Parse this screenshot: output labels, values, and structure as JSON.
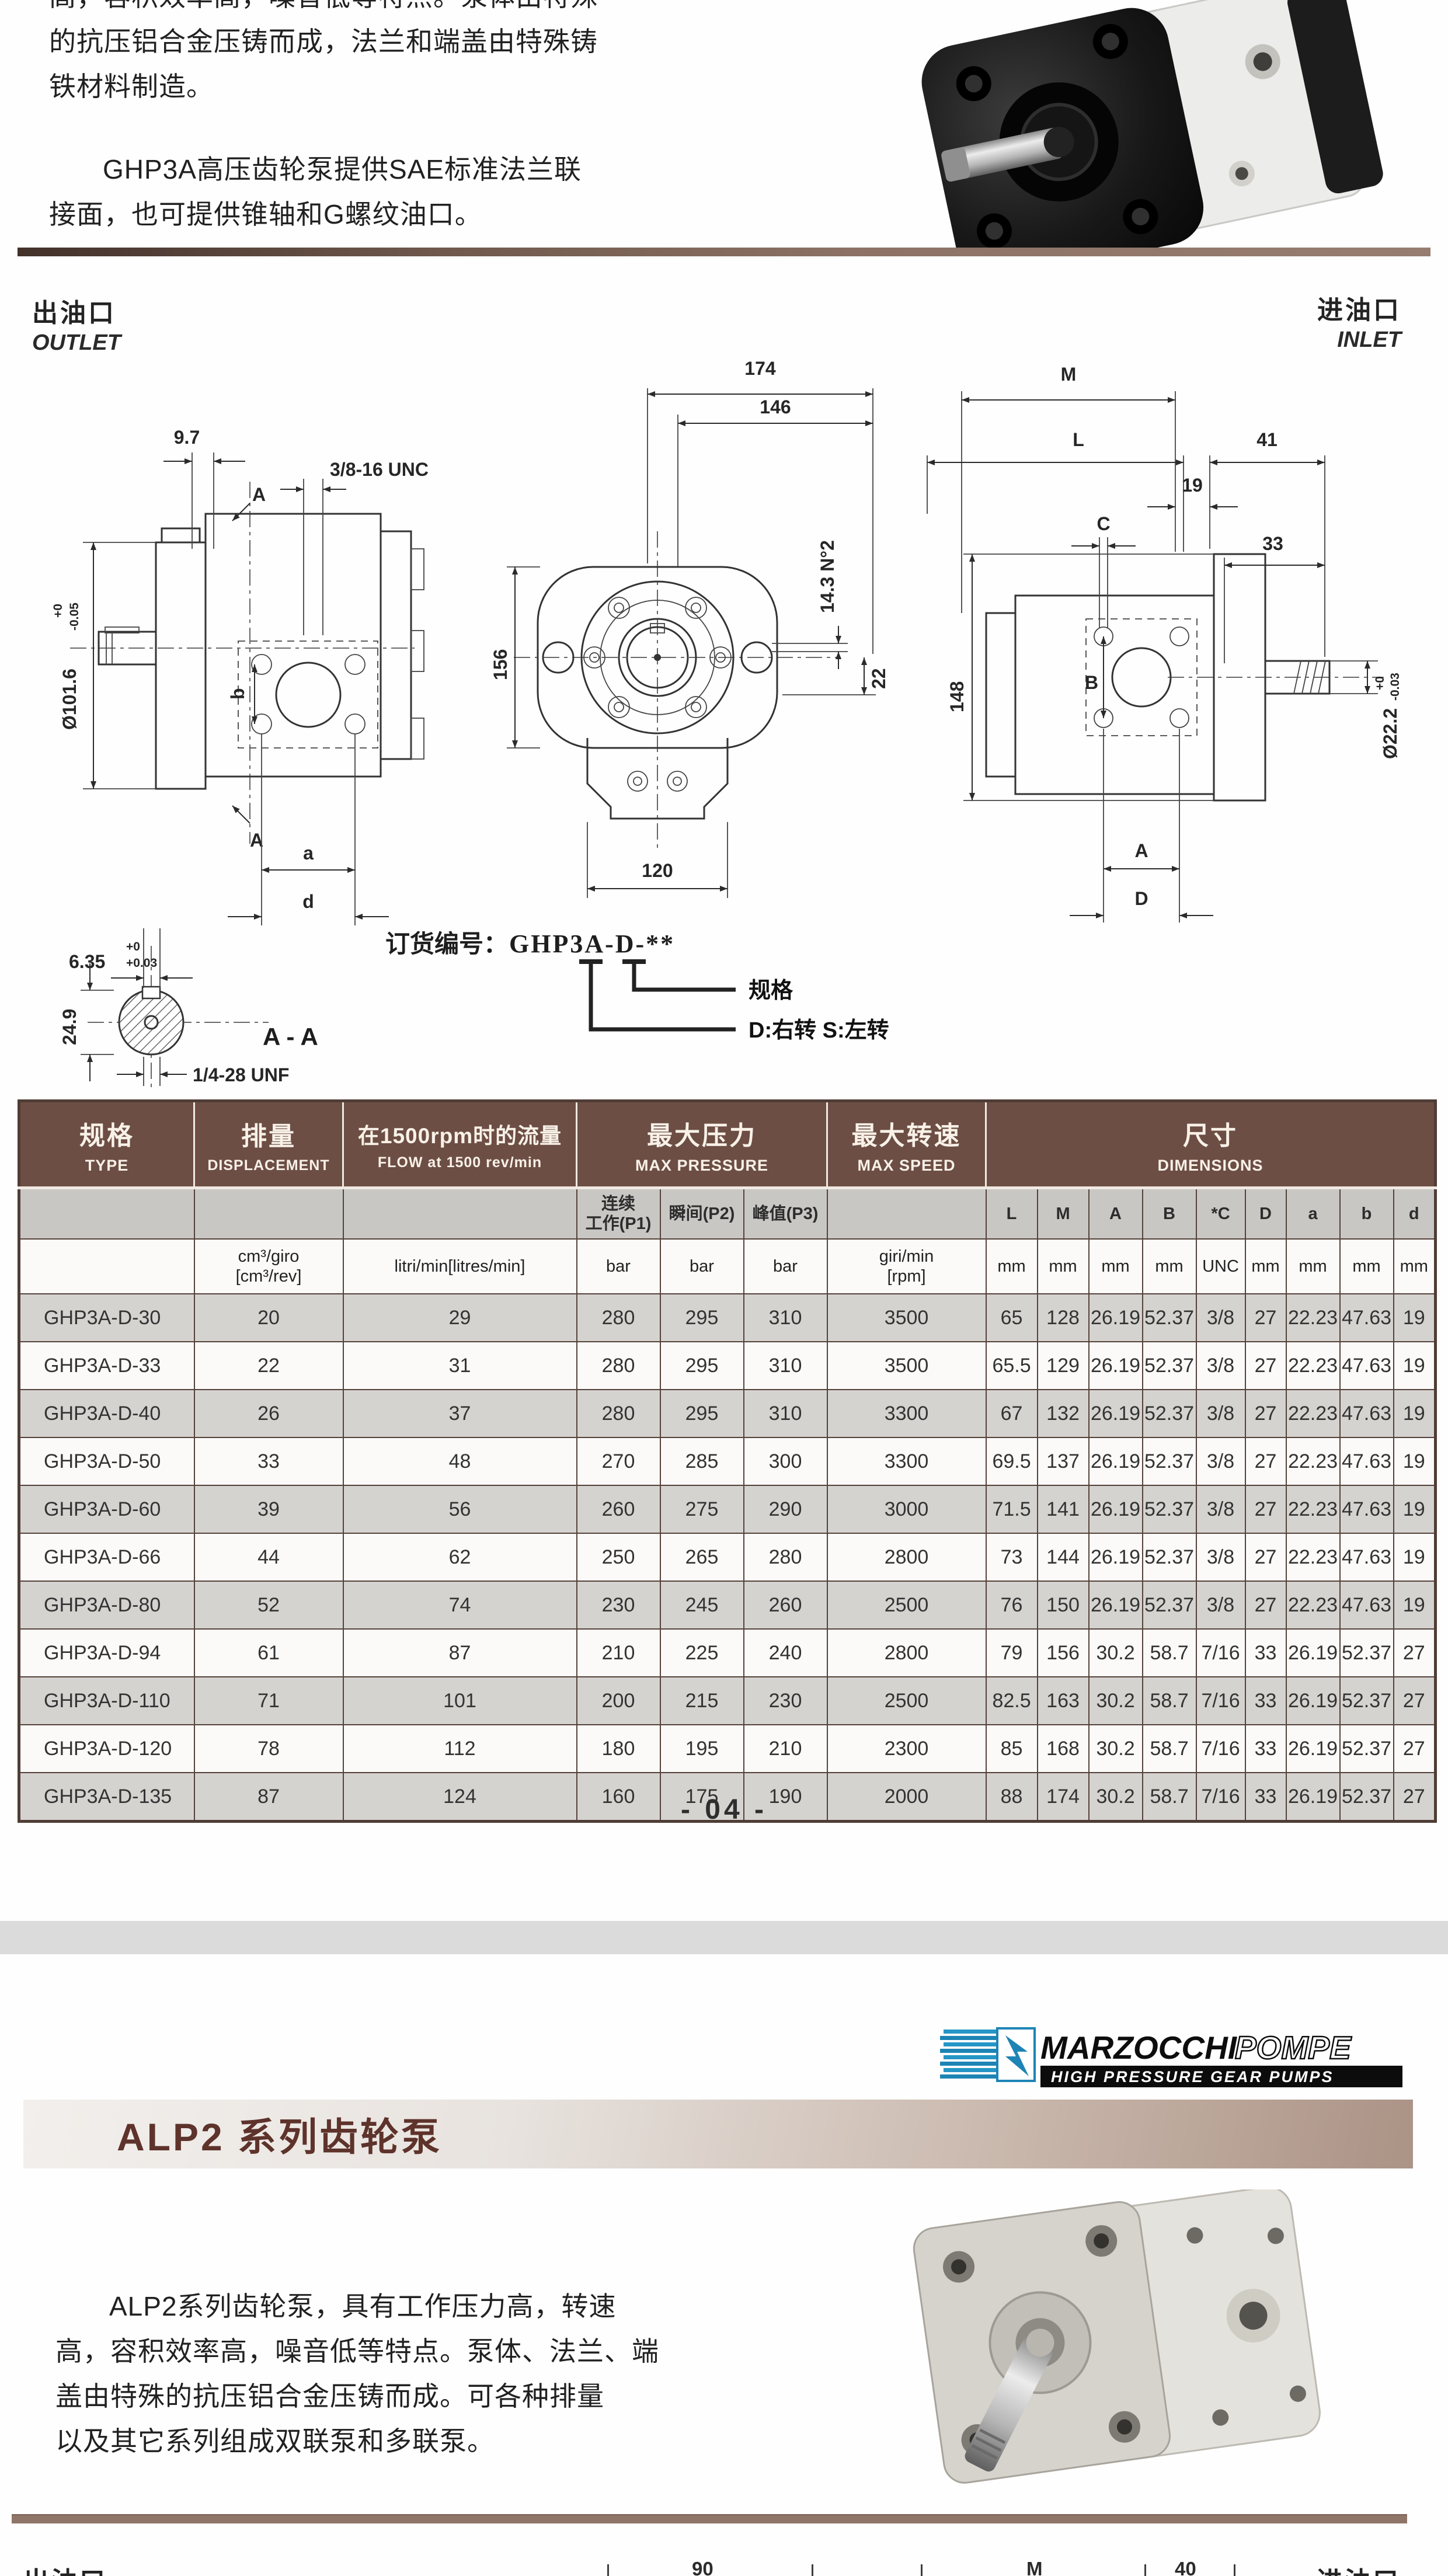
{
  "doc": {
    "page_number": "- 04 -"
  },
  "ghp3a": {
    "para1_clipped": "高，容积效率高，噪音低等特点。泵体由特殊",
    "para1_line2": "的抗压铝合金压铸而成，法兰和端盖由特殊铸",
    "para1_line3": "铁材料制造。",
    "para2_line1": "GHP3A高压齿轮泵提供SAE标准法兰联",
    "para2_line2": "接面，也可提供锥轴和G螺纹油口。",
    "outlet_cn": "出油口",
    "outlet_en": "OUTLET",
    "inlet_cn": "进油口",
    "inlet_en": "INLET",
    "order_code_label": "订货编号：",
    "order_code": "GHP3A-D-**",
    "callout_spec": "规格",
    "callout_rotation": "D:右转  S:左转"
  },
  "drawing_left": {
    "dim_9_7": "9.7",
    "thread": "3/8-16 UNC",
    "section_mark_top": "A",
    "section_mark_bottom": "A",
    "dia": "Ø101.6",
    "dia_tol_top": "+0",
    "dia_tol_bot": "-0.05",
    "dim_b": "b",
    "dim_a": "a",
    "dim_d": "d"
  },
  "shaft_section": {
    "dim_6_35": "6.35",
    "tol_top": "+0",
    "tol_bot": "+0.03",
    "dim_24_9": "24.9",
    "thread": "1/4-28 UNF",
    "title": "A - A"
  },
  "drawing_center": {
    "dim_174": "174",
    "dim_146": "146",
    "dim_156": "156",
    "dim_14_3": "14.3 N°2",
    "dim_22": "22",
    "dim_120": "120"
  },
  "drawing_right": {
    "dim_M": "M",
    "dim_L": "L",
    "dim_41": "41",
    "dim_19": "19",
    "dim_C": "C",
    "dim_33": "33",
    "dim_148": "148",
    "dim_B": "B",
    "dim_A": "A",
    "dim_D": "D",
    "dia": "Ø22.2",
    "dia_tol_top": "+0",
    "dia_tol_bot": "-0.03"
  },
  "table": {
    "header": {
      "type_cn": "规格",
      "type_en": "TYPE",
      "disp_cn": "排量",
      "disp_en": "DISPLACEMENT",
      "flow_cn": "在1500rpm时的流量",
      "flow_en": "FLOW at 1500 rev/min",
      "pressure_cn": "最大压力",
      "pressure_en": "MAX PRESSURE",
      "speed_cn": "最大转速",
      "speed_en": "MAX SPEED",
      "dims_cn": "尺寸",
      "dims_en": "DIMENSIONS"
    },
    "subheader": [
      "",
      "",
      "",
      "连续\n工作(P1)",
      "瞬间(P2)",
      "峰值(P3)",
      "",
      "L",
      "M",
      "A",
      "B",
      "*C",
      "D",
      "a",
      "b",
      "d"
    ],
    "units": [
      "",
      "cm³/giro\n[cm³/rev]",
      "litri/min[litres/min]",
      "bar",
      "bar",
      "bar",
      "giri/min\n[rpm]",
      "mm",
      "mm",
      "mm",
      "mm",
      "UNC",
      "mm",
      "mm",
      "mm",
      "mm"
    ],
    "rows": [
      [
        "GHP3A-D-30",
        "20",
        "29",
        "280",
        "295",
        "310",
        "3500",
        "65",
        "128",
        "26.19",
        "52.37",
        "3/8",
        "27",
        "22.23",
        "47.63",
        "19"
      ],
      [
        "GHP3A-D-33",
        "22",
        "31",
        "280",
        "295",
        "310",
        "3500",
        "65.5",
        "129",
        "26.19",
        "52.37",
        "3/8",
        "27",
        "22.23",
        "47.63",
        "19"
      ],
      [
        "GHP3A-D-40",
        "26",
        "37",
        "280",
        "295",
        "310",
        "3300",
        "67",
        "132",
        "26.19",
        "52.37",
        "3/8",
        "27",
        "22.23",
        "47.63",
        "19"
      ],
      [
        "GHP3A-D-50",
        "33",
        "48",
        "270",
        "285",
        "300",
        "3300",
        "69.5",
        "137",
        "26.19",
        "52.37",
        "3/8",
        "27",
        "22.23",
        "47.63",
        "19"
      ],
      [
        "GHP3A-D-60",
        "39",
        "56",
        "260",
        "275",
        "290",
        "3000",
        "71.5",
        "141",
        "26.19",
        "52.37",
        "3/8",
        "27",
        "22.23",
        "47.63",
        "19"
      ],
      [
        "GHP3A-D-66",
        "44",
        "62",
        "250",
        "265",
        "280",
        "2800",
        "73",
        "144",
        "26.19",
        "52.37",
        "3/8",
        "27",
        "22.23",
        "47.63",
        "19"
      ],
      [
        "GHP3A-D-80",
        "52",
        "74",
        "230",
        "245",
        "260",
        "2500",
        "76",
        "150",
        "26.19",
        "52.37",
        "3/8",
        "27",
        "22.23",
        "47.63",
        "19"
      ],
      [
        "GHP3A-D-94",
        "61",
        "87",
        "210",
        "225",
        "240",
        "2800",
        "79",
        "156",
        "30.2",
        "58.7",
        "7/16",
        "33",
        "26.19",
        "52.37",
        "27"
      ],
      [
        "GHP3A-D-110",
        "71",
        "101",
        "200",
        "215",
        "230",
        "2500",
        "82.5",
        "163",
        "30.2",
        "58.7",
        "7/16",
        "33",
        "26.19",
        "52.37",
        "27"
      ],
      [
        "GHP3A-D-120",
        "78",
        "112",
        "180",
        "195",
        "210",
        "2300",
        "85",
        "168",
        "30.2",
        "58.7",
        "7/16",
        "33",
        "26.19",
        "52.37",
        "27"
      ],
      [
        "GHP3A-D-135",
        "87",
        "124",
        "160",
        "175",
        "190",
        "2000",
        "88",
        "174",
        "30.2",
        "58.7",
        "7/16",
        "33",
        "26.19",
        "52.37",
        "27"
      ]
    ]
  },
  "alp2": {
    "logo_brand_1": "MARZOCCHI",
    "logo_brand_2": "POMPE",
    "logo_tagline": "HIGH PRESSURE GEAR PUMPS",
    "heading": "ALP2 系列齿轮泵",
    "para_line1": "ALP2系列齿轮泵，具有工作压力高，转速",
    "para_line2": "高，容积效率高，噪音低等特点。泵体、法兰、端",
    "para_line3": "盖由特殊的抗压铝合金压铸而成。可各种排量",
    "para_line4": "以及其它系列组成双联泵和多联泵。",
    "bottom_outlet_cn": "出油口",
    "bottom_inlet_cn": "进油口",
    "bottom_dim_90": "90",
    "bottom_dim_M": "M",
    "bottom_dim_40": "40"
  },
  "colors": {
    "header_brown": "#6d4e44",
    "bar_brown": "#8f7568",
    "accent_maroon": "#5e332b"
  }
}
